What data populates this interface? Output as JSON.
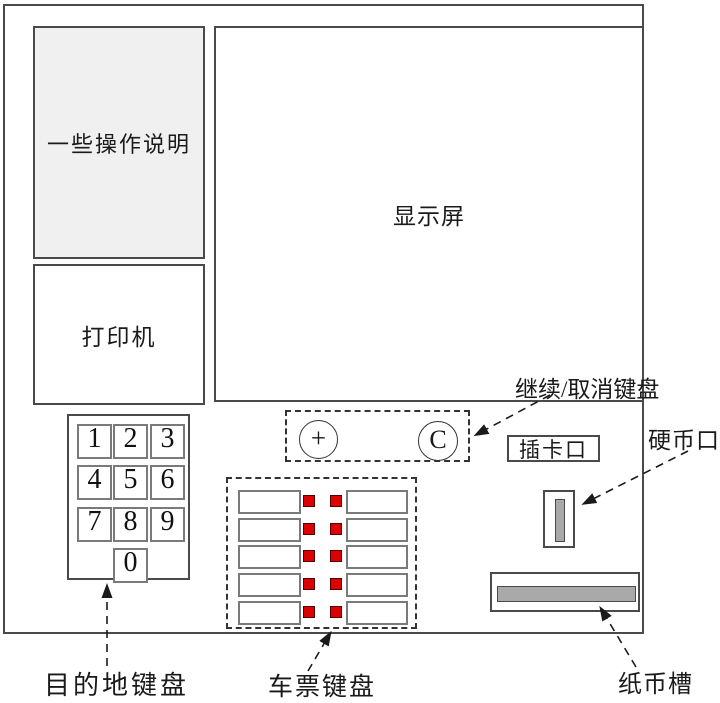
{
  "colors": {
    "accent_red": "#dd0000",
    "panel_fill": "#f0f0f0",
    "slot_fill": "#a9a9a9"
  },
  "machine": {
    "instructions_label": "一些操作说明",
    "printer_label": "打印机",
    "display_label": "显示屏",
    "card_slot_label": "插卡口"
  },
  "destination_keypad": {
    "keys": [
      "1",
      "2",
      "3",
      "4",
      "5",
      "6",
      "7",
      "8",
      "9",
      "0"
    ],
    "caption": "目的地键盘"
  },
  "continue_cancel_keypad": {
    "plus_key": "+",
    "cancel_key": "C",
    "caption": "继续/取消键盘"
  },
  "ticket_keypad": {
    "caption": "车票键盘",
    "row_count": 5
  },
  "coin_slot": {
    "caption": "硬币口"
  },
  "banknote_slot": {
    "caption": "纸币槽"
  }
}
